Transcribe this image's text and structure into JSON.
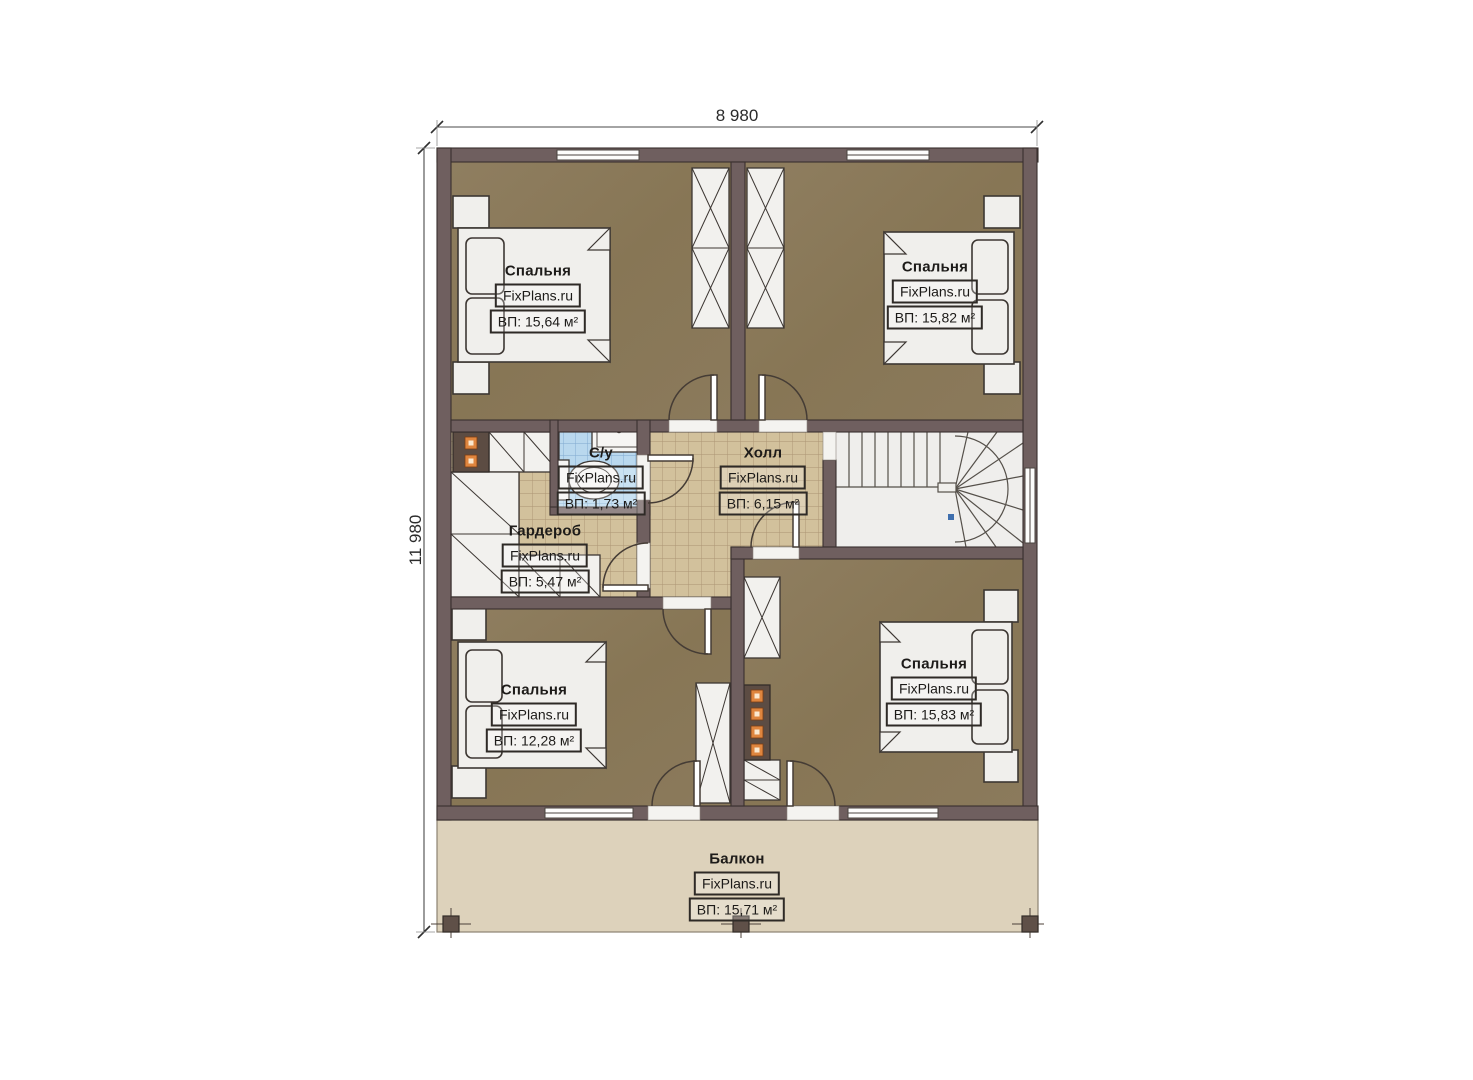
{
  "plan": {
    "dimensions": {
      "width_label": "8 980",
      "height_label": "11 980"
    },
    "watermark": "FixPlans.ru",
    "rooms": [
      {
        "key": "bedroom-top-left",
        "name": "Спальня",
        "watermark": "FixPlans.ru",
        "area": "ВП: 15,64 м²"
      },
      {
        "key": "bedroom-top-right",
        "name": "Спальня",
        "watermark": "FixPlans.ru",
        "area": "ВП: 15,82 м²"
      },
      {
        "key": "bathroom",
        "name": "С/у",
        "watermark": "FixPlans.ru",
        "area": "ВП: 1,73 м²"
      },
      {
        "key": "hall",
        "name": "Холл",
        "watermark": "FixPlans.ru",
        "area": "ВП: 6,15 м²"
      },
      {
        "key": "wardrobe",
        "name": "Гардероб",
        "watermark": "FixPlans.ru",
        "area": "ВП: 5,47 м²"
      },
      {
        "key": "bedroom-bottom-left",
        "name": "Спальня",
        "watermark": "FixPlans.ru",
        "area": "ВП: 12,28 м²"
      },
      {
        "key": "bedroom-bottom-right",
        "name": "Спальня",
        "watermark": "FixPlans.ru",
        "area": "ВП: 15,83 м²"
      },
      {
        "key": "balcony",
        "name": "Балкон",
        "watermark": "FixPlans.ru",
        "area": "ВП: 15,71 м²"
      }
    ],
    "colors": {
      "wall": "#6f5f5f",
      "wall_outline": "#39302f",
      "bedroom_floor": "#8b7a5c",
      "tile_floor": "#d2c19c",
      "tile_line": "#ab9372",
      "bath_tile": "#b9d8ee",
      "bath_tile_line": "#7fa9cf",
      "balcony_floor": "#ddd2bb",
      "fixture_white": "#f0efec",
      "chimney": "#5c4c43",
      "chimney_dot": "#df853e"
    }
  }
}
